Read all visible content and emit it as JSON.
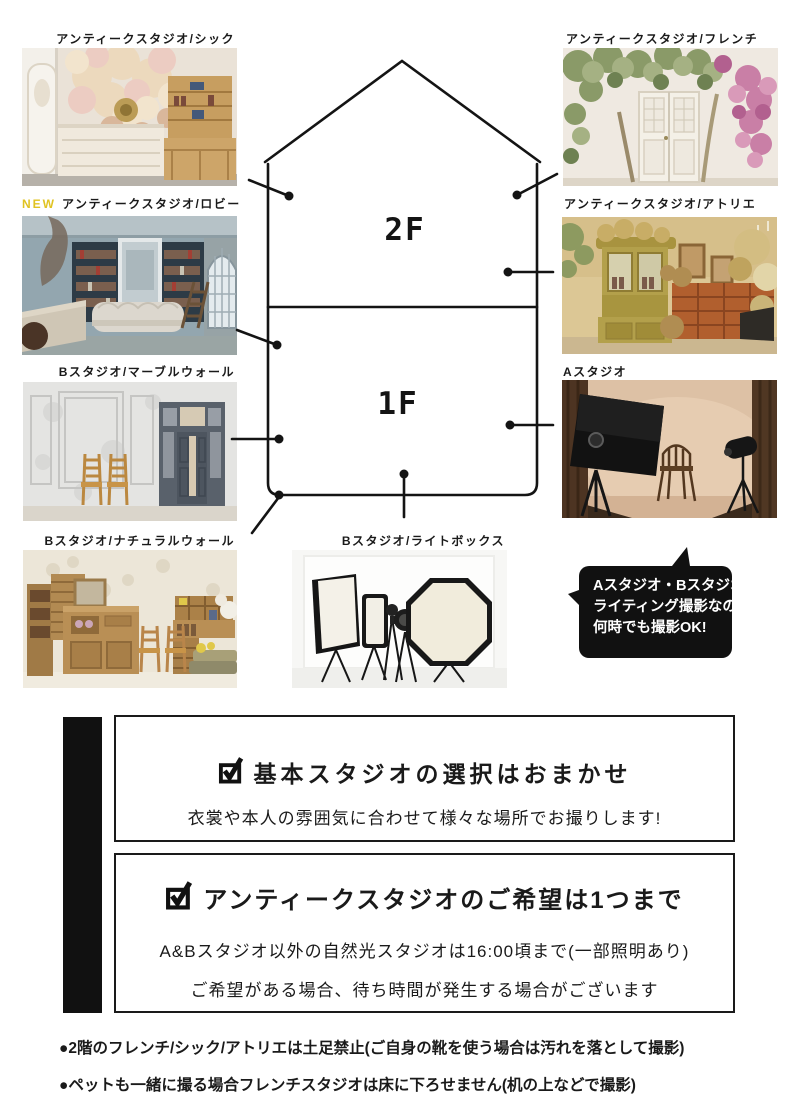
{
  "colors": {
    "accent_new": "#e0c322",
    "ink": "#1a1a1a",
    "bubble_bg": "#111111",
    "bubble_text": "#ffffff"
  },
  "studios": {
    "chic": {
      "label": "アンティークスタジオ/シック"
    },
    "french": {
      "label": "アンティークスタジオ/フレンチ"
    },
    "lobby": {
      "badge": "NEW",
      "label": "アンティークスタジオ/ロビー"
    },
    "atelier": {
      "label": "アンティークスタジオ/アトリエ"
    },
    "marble": {
      "label": "Bスタジオ/マーブルウォール"
    },
    "a_studio": {
      "label": "Aスタジオ"
    },
    "natural": {
      "label": "Bスタジオ/ナチュラルウォール"
    },
    "lightbox": {
      "label": "Bスタジオ/ライトボックス"
    }
  },
  "floors": {
    "second": "2F",
    "first": "1F"
  },
  "speech_bubble": {
    "lines": [
      "Aスタジオ・Bスタジオは",
      "ライティング撮影なので",
      "何時でも撮影OK!"
    ]
  },
  "info_boxes": [
    {
      "title": "基本スタジオの選択はおまかせ",
      "body": [
        "衣裳や本人の雰囲気に合わせて様々な場所でお撮りします!"
      ]
    },
    {
      "title": "アンティークスタジオのご希望は1つまで",
      "body": [
        "A&Bスタジオ以外の自然光スタジオは16:00頃まで(一部照明あり)",
        "ご希望がある場合、待ち時間が発生する場合がございます"
      ]
    }
  ],
  "notes": [
    "●2階のフレンチ/シック/アトリエは土足禁止(ご自身の靴を使う場合は汚れを落として撮影)",
    "●ペットも一緒に撮る場合フレンチスタジオは床に下ろせません(机の上などで撮影)"
  ]
}
